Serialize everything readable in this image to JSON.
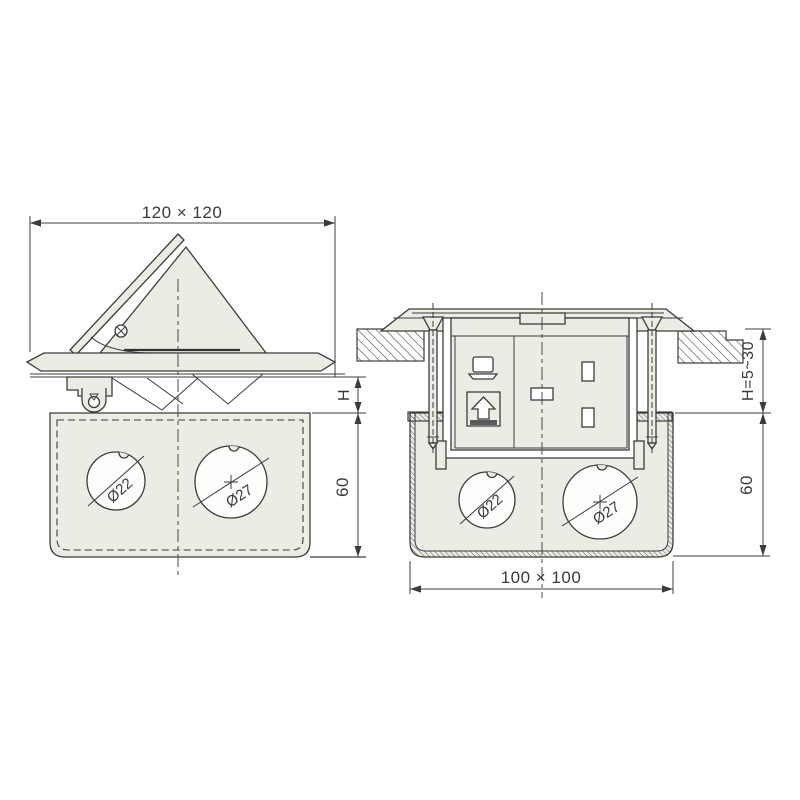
{
  "colors": {
    "background": "#ffffff",
    "line": "#3c3c3c",
    "part_fill": "#ecebe4",
    "knockout_fill": "#fdfdfb"
  },
  "views": {
    "open": {
      "dim_square": "120 × 120",
      "dim_cover_height": "H",
      "dim_box_depth": "60",
      "knockout_small": "Ø22",
      "knockout_large": "Ø27"
    },
    "installed": {
      "dim_floor_height": "H=5~30",
      "dim_box_depth": "60",
      "dim_square": "100 × 100",
      "knockout_small": "Ø22",
      "knockout_large": "Ø27"
    }
  }
}
